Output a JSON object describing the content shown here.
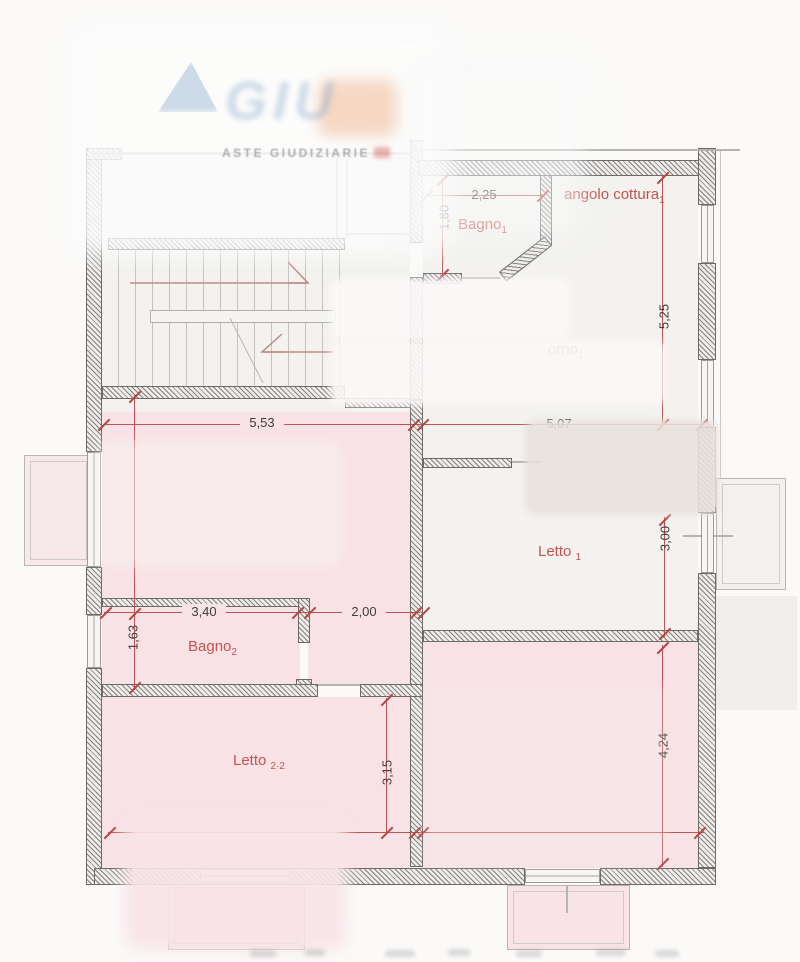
{
  "watermark": {
    "logo_text": "GIU",
    "subtitle": "ASTE GIUDIZIARIE"
  },
  "room_labels": {
    "bagno1": {
      "text": "Bagno",
      "sub": "1"
    },
    "angolo_cottura": {
      "text": "angolo cottura",
      "sub": "1"
    },
    "soggiorno_fragment": {
      "text": "orno",
      "sub": "1"
    },
    "letto1": {
      "text": "Letto ",
      "sub": "1"
    },
    "bagno2": {
      "text": "Bagno",
      "sub": "2"
    },
    "letto2": {
      "text": "Letto ",
      "sub": "2·2"
    }
  },
  "dimensions": {
    "bagno1_width": "2,25",
    "bagno1_depth": "1,80",
    "unit1_right_height": "5,25",
    "left_zone_width": "5,53",
    "right_zone_width": "5,07",
    "letto1_depth": "3,00",
    "bagno2_width": "3,40",
    "corridor_width": "2,00",
    "bagno2_depth": "1,63",
    "letto2_depth": "3,15",
    "room_br_depth": "4,24"
  },
  "colors": {
    "room_pink": "#f8e2e5",
    "room_white": "#f3f2ef",
    "dimension_red": "#bf5552",
    "label_red": "#c4524f"
  }
}
